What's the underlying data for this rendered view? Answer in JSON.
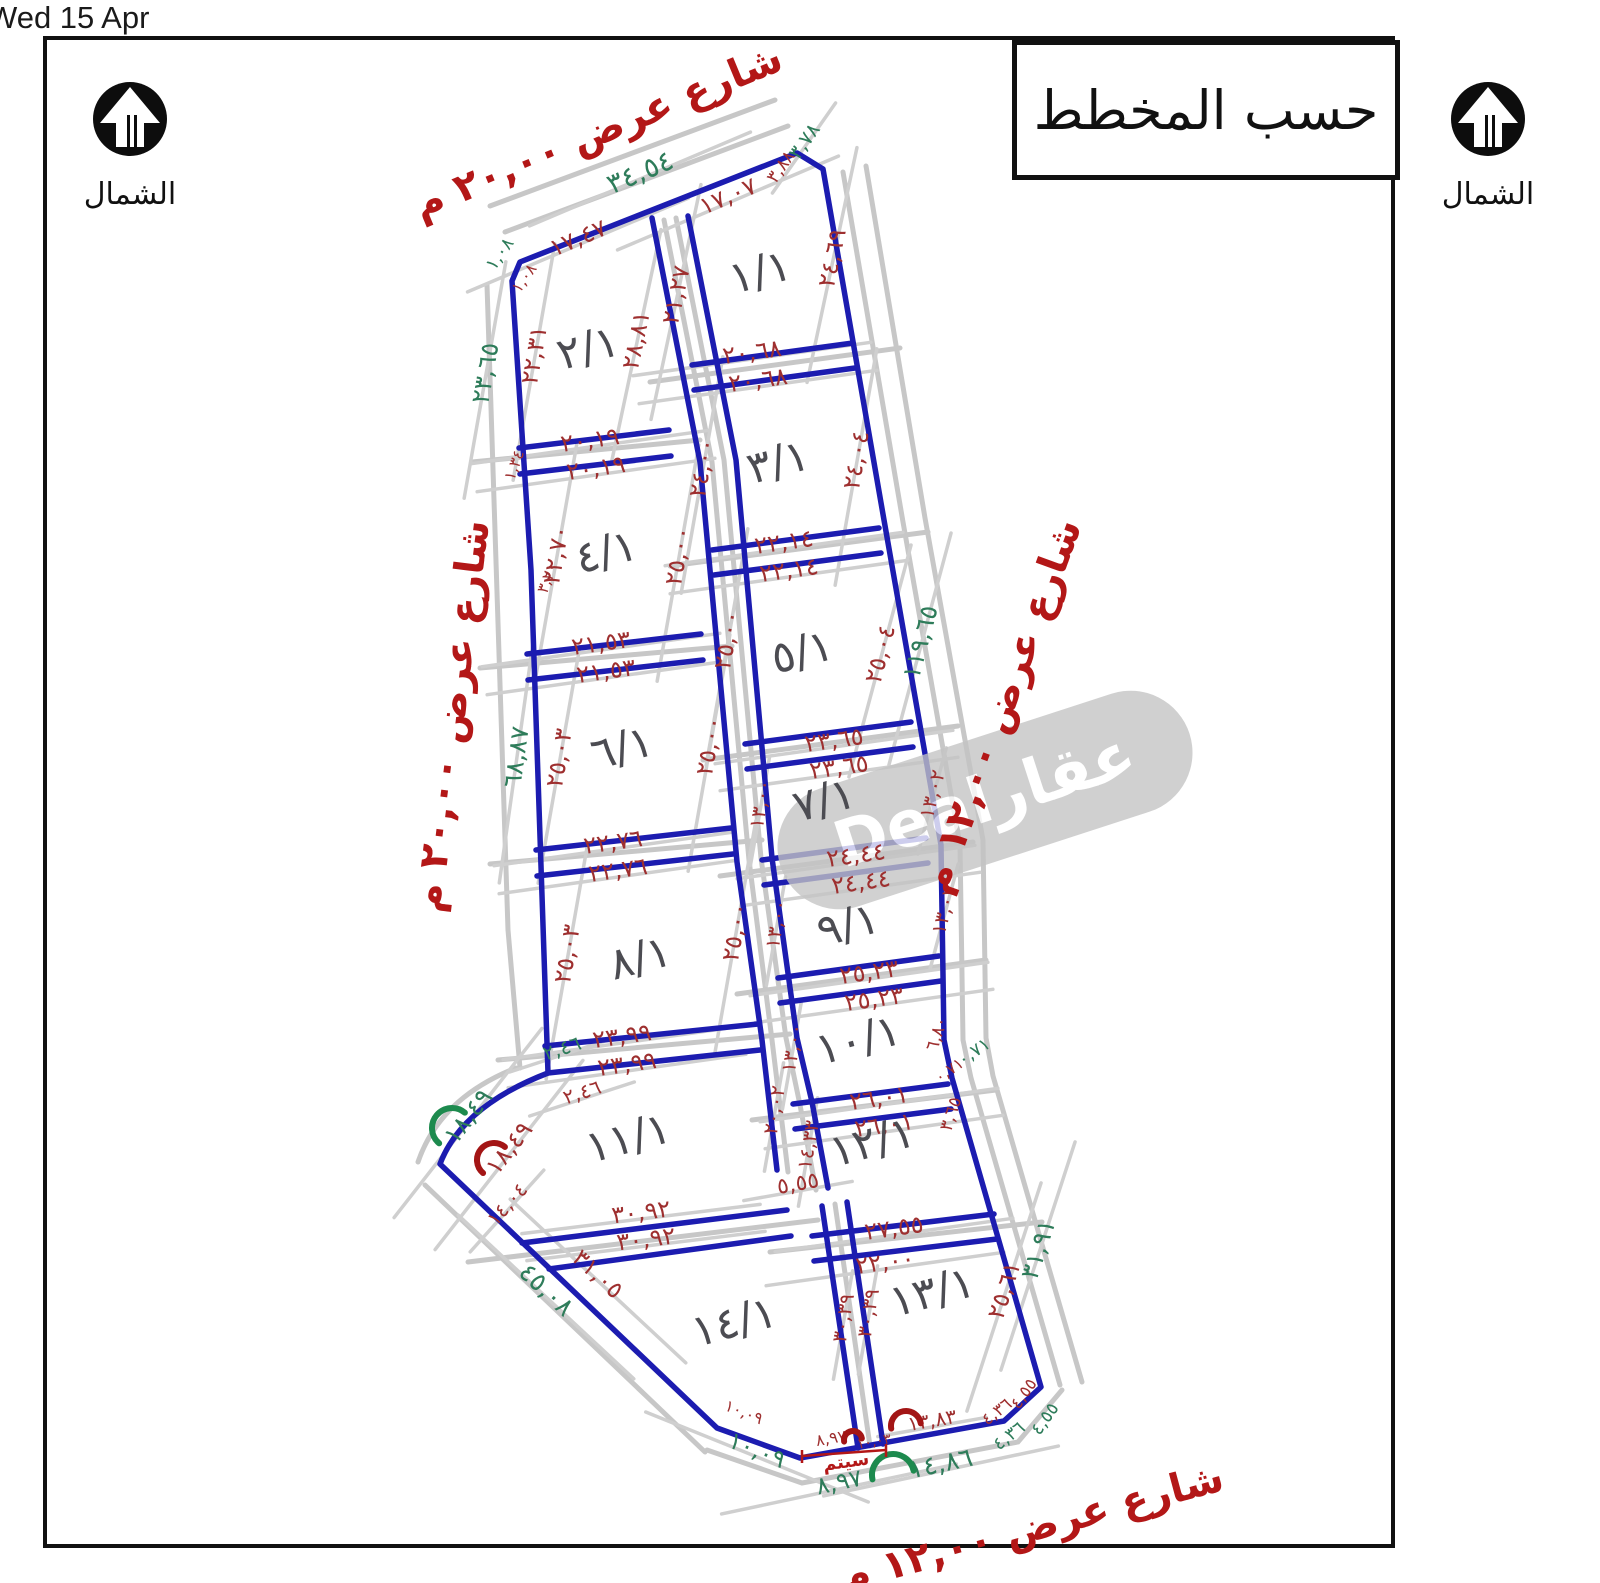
{
  "window": {
    "datetime": "Wed 15 Apr"
  },
  "legend": {
    "title": "حسب المخطط"
  },
  "north": {
    "label": "الشمال"
  },
  "watermark": {
    "text": "عقارDeal",
    "x": 985,
    "y": 800,
    "rot": -18,
    "w": 430,
    "h": 124
  },
  "colors": {
    "plot_line": "#1c1cb0",
    "road_line": "#c7c7c7",
    "dim_red": "#9e2f2f",
    "dim_green": "#2e7c5a",
    "street_red": "#b31717",
    "plot_label": "#4c4c52",
    "arc_red": "#a31515",
    "arc_green": "#1d8a4e",
    "frame": "#111111",
    "watermark_bg": "#c4c4c4"
  },
  "map": {
    "streets": [
      {
        "id": "street-top",
        "t": "شارع عرض ٢٠,٠٠ م",
        "x": 598,
        "y": 132,
        "r": -22.5
      },
      {
        "id": "street-left",
        "t": "شارع عرض ٢٠,٠٠ م",
        "x": 452,
        "y": 716,
        "r": -83
      },
      {
        "id": "street-right",
        "t": "شارع عرض ١٢,٠٠ م",
        "x": 1002,
        "y": 706,
        "r": -70
      },
      {
        "id": "street-bottom",
        "t": "شارع عرض ١٢,٠٠ م",
        "x": 1032,
        "y": 1528,
        "r": -15
      }
    ],
    "plots": [
      {
        "t": "١/١",
        "x": 760,
        "y": 272
      },
      {
        "t": "٢/١",
        "x": 588,
        "y": 348
      },
      {
        "t": "٣/١",
        "x": 778,
        "y": 462
      },
      {
        "t": "٤/١",
        "x": 606,
        "y": 552
      },
      {
        "t": "٥/١",
        "x": 802,
        "y": 652
      },
      {
        "t": "٦/١",
        "x": 622,
        "y": 748
      },
      {
        "t": "٧/١",
        "x": 824,
        "y": 800
      },
      {
        "t": "٨/١",
        "x": 640,
        "y": 958
      },
      {
        "t": "٩/١",
        "x": 848,
        "y": 925
      },
      {
        "t": "١٠/١",
        "x": 858,
        "y": 1040
      },
      {
        "t": "١١/١",
        "x": 628,
        "y": 1138
      },
      {
        "t": "١٢/١",
        "x": 872,
        "y": 1142
      },
      {
        "t": "١٣/١",
        "x": 932,
        "y": 1292
      },
      {
        "t": "١٤/١",
        "x": 734,
        "y": 1322
      }
    ],
    "dims_red": [
      {
        "t": "١٧,٤٧",
        "x": 578,
        "y": 238,
        "r": -23
      },
      {
        "t": "١٧,٠٧",
        "x": 728,
        "y": 196,
        "r": -23
      },
      {
        "t": "٣,٨٨",
        "x": 781,
        "y": 167,
        "r": -55,
        "s": 18
      },
      {
        "t": "١,٠٨",
        "x": 524,
        "y": 278,
        "r": -55,
        "s": 16
      },
      {
        "t": "٢١,٢٧",
        "x": 676,
        "y": 295,
        "r": -78
      },
      {
        "t": "٢٨,٨١",
        "x": 636,
        "y": 340,
        "r": -78
      },
      {
        "t": "٢٢,٣١",
        "x": 534,
        "y": 355,
        "r": -80
      },
      {
        "t": "٢٤,٦٩",
        "x": 832,
        "y": 258,
        "r": -78
      },
      {
        "t": "٢٠,٦٨",
        "x": 752,
        "y": 352,
        "r": -8
      },
      {
        "t": "٢٠,٦٨",
        "x": 758,
        "y": 380,
        "r": -8
      },
      {
        "t": "٢٠,١٩",
        "x": 590,
        "y": 440,
        "r": -8
      },
      {
        "t": "٢٠,١٩",
        "x": 596,
        "y": 468,
        "r": -8
      },
      {
        "t": "١,٣٤",
        "x": 514,
        "y": 465,
        "r": -70,
        "s": 16
      },
      {
        "t": "٢٤,٠٠",
        "x": 702,
        "y": 468,
        "r": -80
      },
      {
        "t": "٢٤,٠٤",
        "x": 856,
        "y": 460,
        "r": -80
      },
      {
        "t": "٢٢,٧٠",
        "x": 556,
        "y": 555,
        "r": -80
      },
      {
        "t": "٢٥,٠٠",
        "x": 678,
        "y": 556,
        "r": -80
      },
      {
        "t": "٢٢,١٤",
        "x": 784,
        "y": 542,
        "r": -8
      },
      {
        "t": "٢٢,١٤",
        "x": 789,
        "y": 570,
        "r": -8
      },
      {
        "t": "٣,٢٠",
        "x": 547,
        "y": 578,
        "r": -70,
        "s": 16
      },
      {
        "t": "٢١,٥٣",
        "x": 601,
        "y": 643,
        "r": -8
      },
      {
        "t": "٢١,٥٣",
        "x": 606,
        "y": 671,
        "r": -8
      },
      {
        "t": "٢٥,٠٠",
        "x": 727,
        "y": 640,
        "r": -80
      },
      {
        "t": "٢٥,٠٤",
        "x": 880,
        "y": 654,
        "r": -75
      },
      {
        "t": "٢٥,٠٣",
        "x": 559,
        "y": 758,
        "r": -80
      },
      {
        "t": "٢٥,٠٠",
        "x": 709,
        "y": 746,
        "r": -80
      },
      {
        "t": "٢٣,٦٥",
        "x": 834,
        "y": 740,
        "r": -8
      },
      {
        "t": "٢٣,٦٥",
        "x": 839,
        "y": 767,
        "r": -8
      },
      {
        "t": "١٣,٠٠",
        "x": 760,
        "y": 804,
        "r": -80,
        "s": 20
      },
      {
        "t": "١٣,٠٢",
        "x": 932,
        "y": 794,
        "r": -75,
        "s": 20
      },
      {
        "t": "٢٢,٧٦",
        "x": 613,
        "y": 842,
        "r": -8
      },
      {
        "t": "٢٢,٧٦",
        "x": 618,
        "y": 870,
        "r": -8
      },
      {
        "t": "٢٤,٤٤",
        "x": 856,
        "y": 855,
        "r": -8
      },
      {
        "t": "٢٤,٤٤",
        "x": 861,
        "y": 882,
        "r": -8
      },
      {
        "t": "٢٥,٠٣",
        "x": 567,
        "y": 954,
        "r": -80
      },
      {
        "t": "٢٥,٠٠",
        "x": 735,
        "y": 932,
        "r": -80
      },
      {
        "t": "١٣,٠٠",
        "x": 776,
        "y": 924,
        "r": -80,
        "s": 20
      },
      {
        "t": "١٣,٠٢",
        "x": 944,
        "y": 910,
        "r": -75,
        "s": 20
      },
      {
        "t": "٢٥,٢٣",
        "x": 869,
        "y": 972,
        "r": -8
      },
      {
        "t": "٢٥,٢٣",
        "x": 874,
        "y": 999,
        "r": -8
      },
      {
        "t": "٢٣,٩٩",
        "x": 622,
        "y": 1036,
        "r": -8
      },
      {
        "t": "٢٣,٩٩",
        "x": 627,
        "y": 1064,
        "r": -8
      },
      {
        "t": "١٣,٠٠",
        "x": 792,
        "y": 1048,
        "r": -80,
        "s": 20
      },
      {
        "t": "٦,٨٠",
        "x": 937,
        "y": 1034,
        "r": -72,
        "s": 18
      },
      {
        "t": "٠,٧١",
        "x": 949,
        "y": 1070,
        "r": -35,
        "s": 16
      },
      {
        "t": "٣,٦٥",
        "x": 951,
        "y": 1114,
        "r": -72,
        "s": 18
      },
      {
        "t": "٢٦,٠١",
        "x": 879,
        "y": 1098,
        "r": -8
      },
      {
        "t": "٢٦,٠١",
        "x": 884,
        "y": 1125,
        "r": -8
      },
      {
        "t": "٢٠,٠٢",
        "x": 774,
        "y": 1110,
        "r": -80,
        "s": 20
      },
      {
        "t": "١٤,٣٣",
        "x": 808,
        "y": 1145,
        "r": -80,
        "s": 20
      },
      {
        "t": "٢,٤٦",
        "x": 582,
        "y": 1092,
        "r": -18,
        "s": 20
      },
      {
        "t": "١٨,٤٩",
        "x": 509,
        "y": 1148,
        "r": -52
      },
      {
        "t": "١٤,٠٤",
        "x": 507,
        "y": 1204,
        "r": -48,
        "s": 20
      },
      {
        "t": "٢٧,٥٥",
        "x": 894,
        "y": 1228,
        "r": -8
      },
      {
        "t": "٢٢,٠٠",
        "x": 885,
        "y": 1262,
        "r": -8
      },
      {
        "t": "٣٠,٩٢",
        "x": 641,
        "y": 1212,
        "r": -7
      },
      {
        "t": "٣٠,٩٢",
        "x": 646,
        "y": 1239,
        "r": -7
      },
      {
        "t": "٥,٥٥",
        "x": 798,
        "y": 1184,
        "r": -10,
        "s": 22
      },
      {
        "t": "٣٠,٣٩",
        "x": 843,
        "y": 1318,
        "r": -80,
        "s": 20
      },
      {
        "t": "٣٠,٣٩",
        "x": 868,
        "y": 1313,
        "r": -80,
        "s": 20
      },
      {
        "t": "٢٥,٦١",
        "x": 1004,
        "y": 1290,
        "r": -72
      },
      {
        "t": "٣١,٠٥",
        "x": 598,
        "y": 1274,
        "r": 43
      },
      {
        "t": "١٠,٠٩",
        "x": 744,
        "y": 1412,
        "r": 22,
        "s": 16
      },
      {
        "t": "٨,٩٧",
        "x": 831,
        "y": 1438,
        "r": -10,
        "s": 16
      },
      {
        "t": "١٠,٠٣",
        "x": 874,
        "y": 1442,
        "r": -10,
        "s": 14
      },
      {
        "t": "١٣,٨٣",
        "x": 932,
        "y": 1420,
        "r": -10,
        "s": 20
      },
      {
        "t": "٤,٣٦",
        "x": 997,
        "y": 1412,
        "r": -38,
        "s": 17
      },
      {
        "t": "٤,٥٥",
        "x": 1024,
        "y": 1394,
        "r": -55,
        "s": 17
      }
    ],
    "dims_green": [
      {
        "t": "١,٠٨",
        "x": 500,
        "y": 254,
        "r": -55,
        "s": 18
      },
      {
        "t": "٣٤,٥٤",
        "x": 640,
        "y": 172,
        "r": -23,
        "s": 28
      },
      {
        "t": "٣,٧٨",
        "x": 804,
        "y": 141,
        "r": -55,
        "s": 20
      },
      {
        "t": "٢٣,٦٥",
        "x": 485,
        "y": 373,
        "r": -80
      },
      {
        "t": "٦٨,٨٧",
        "x": 516,
        "y": 757,
        "r": -82
      },
      {
        "t": "١١٩,٦٥",
        "x": 920,
        "y": 642,
        "r": -75
      },
      {
        "t": "٠,٧١",
        "x": 974,
        "y": 1052,
        "r": -35,
        "s": 18
      },
      {
        "t": "٢,٤٦",
        "x": 562,
        "y": 1048,
        "r": -18,
        "s": 20
      },
      {
        "t": "١٨,٤٩",
        "x": 468,
        "y": 1116,
        "r": -52
      },
      {
        "t": "٣١,٩١",
        "x": 1038,
        "y": 1249,
        "r": -72
      },
      {
        "t": "٤,٣٦",
        "x": 1009,
        "y": 1436,
        "r": -38,
        "s": 18
      },
      {
        "t": "٤,٥٥",
        "x": 1045,
        "y": 1419,
        "r": -55,
        "s": 18
      },
      {
        "t": "١٤,٨٦",
        "x": 941,
        "y": 1464,
        "r": -12,
        "s": 26
      },
      {
        "t": "٨,٩٧",
        "x": 839,
        "y": 1482,
        "r": -12,
        "s": 24
      },
      {
        "t": "١٠,٠٩",
        "x": 757,
        "y": 1450,
        "r": 22,
        "s": 24
      },
      {
        "t": "٤٥,٠٨",
        "x": 546,
        "y": 1290,
        "r": 43,
        "s": 26
      }
    ],
    "arcs": [
      {
        "x": 452,
        "y": 1128,
        "r": -50,
        "rad": 20,
        "c": "green"
      },
      {
        "x": 494,
        "y": 1160,
        "r": -50,
        "rad": 17,
        "c": "red"
      },
      {
        "x": 906,
        "y": 1426,
        "r": -10,
        "rad": 15,
        "c": "red"
      },
      {
        "x": 853,
        "y": 1440,
        "r": -10,
        "rad": 9,
        "c": "red"
      },
      {
        "x": 893,
        "y": 1475,
        "r": -12,
        "rad": 21,
        "c": "green"
      }
    ],
    "note": {
      "t": "سيتم",
      "x": 846,
      "y": 1462,
      "r": -8,
      "s": 18,
      "bracket": "M802,1456 L886,1450 M802,1450 L802,1463 M886,1444 L886,1457"
    },
    "geometry": {
      "blue": [
        "M520,262 L797,153 L823,169 L884,520 L941,845 L944,1040 L952,1078 L1041,1387 L1004,1421 L800,1458 L717,1428 L440,1164 Q462,1106 548,1073 L531,570 L512,281 Z",
        "M652,218 L700,462 L737,862 L762,1040 L777,1170",
        "M688,216 L736,460 L772,858 L797,1038 L812,1102 L828,1188",
        "M822,1206 L858,1448",
        "M847,1202 L883,1444",
        "M692,365 L853,343",
        "M694,390 L855,368",
        "M712,550 L879,528",
        "M714,575 L881,553",
        "M745,744 L911,722",
        "M747,769 L913,747",
        "M762,860 L926,838",
        "M764,885 L928,863",
        "M778,978 L939,956",
        "M780,1003 L941,981",
        "M793,1104 L948,1084",
        "M795,1129 L951,1109",
        "M812,1236 L994,1214",
        "M814,1261 L997,1239",
        "M519,448 L669,430",
        "M520,474 L671,456",
        "M527,654 L701,634",
        "M528,680 L703,660",
        "M536,850 L731,828",
        "M537,876 L733,854",
        "M545,1046 L758,1024",
        "M548,1073 L760,1050",
        "M522,1243 L787,1210",
        "M549,1269 L791,1236"
      ],
      "gray": [
        "M505,232 L788,126",
        "M490,206 L775,100",
        "M843,172 L903,522 L960,845 L963,1040 L971,1078 L1060,1385",
        "M866,166 L925,518 L983,840 L986,1038 L993,1076 L1082,1382",
        "M1062,1390 L1018,1442 L802,1483 L707,1450",
        "M425,1185 L705,1452",
        "M487,285 L508,930 L520,1068",
        "M516,1068 Q440,1098 418,1162",
        "M664,220 L712,462 L749,860 L772,1040 L788,1172",
        "M676,218 L724,460 L761,858 L786,1038 L800,1105 L816,1190",
        "M835,1204 L870,1446",
        "M650,382 L900,348",
        "M670,566 L928,532",
        "M703,760 L958,726",
        "M720,876 L973,842",
        "M737,994 L986,960",
        "M752,1120 L996,1090",
        "M770,1252 L1042,1222",
        "M472,462 L700,440",
        "M480,668 L732,646",
        "M490,864 L762,840",
        "M498,1060 L790,1034",
        "M468,1262 L818,1220"
      ]
    }
  }
}
